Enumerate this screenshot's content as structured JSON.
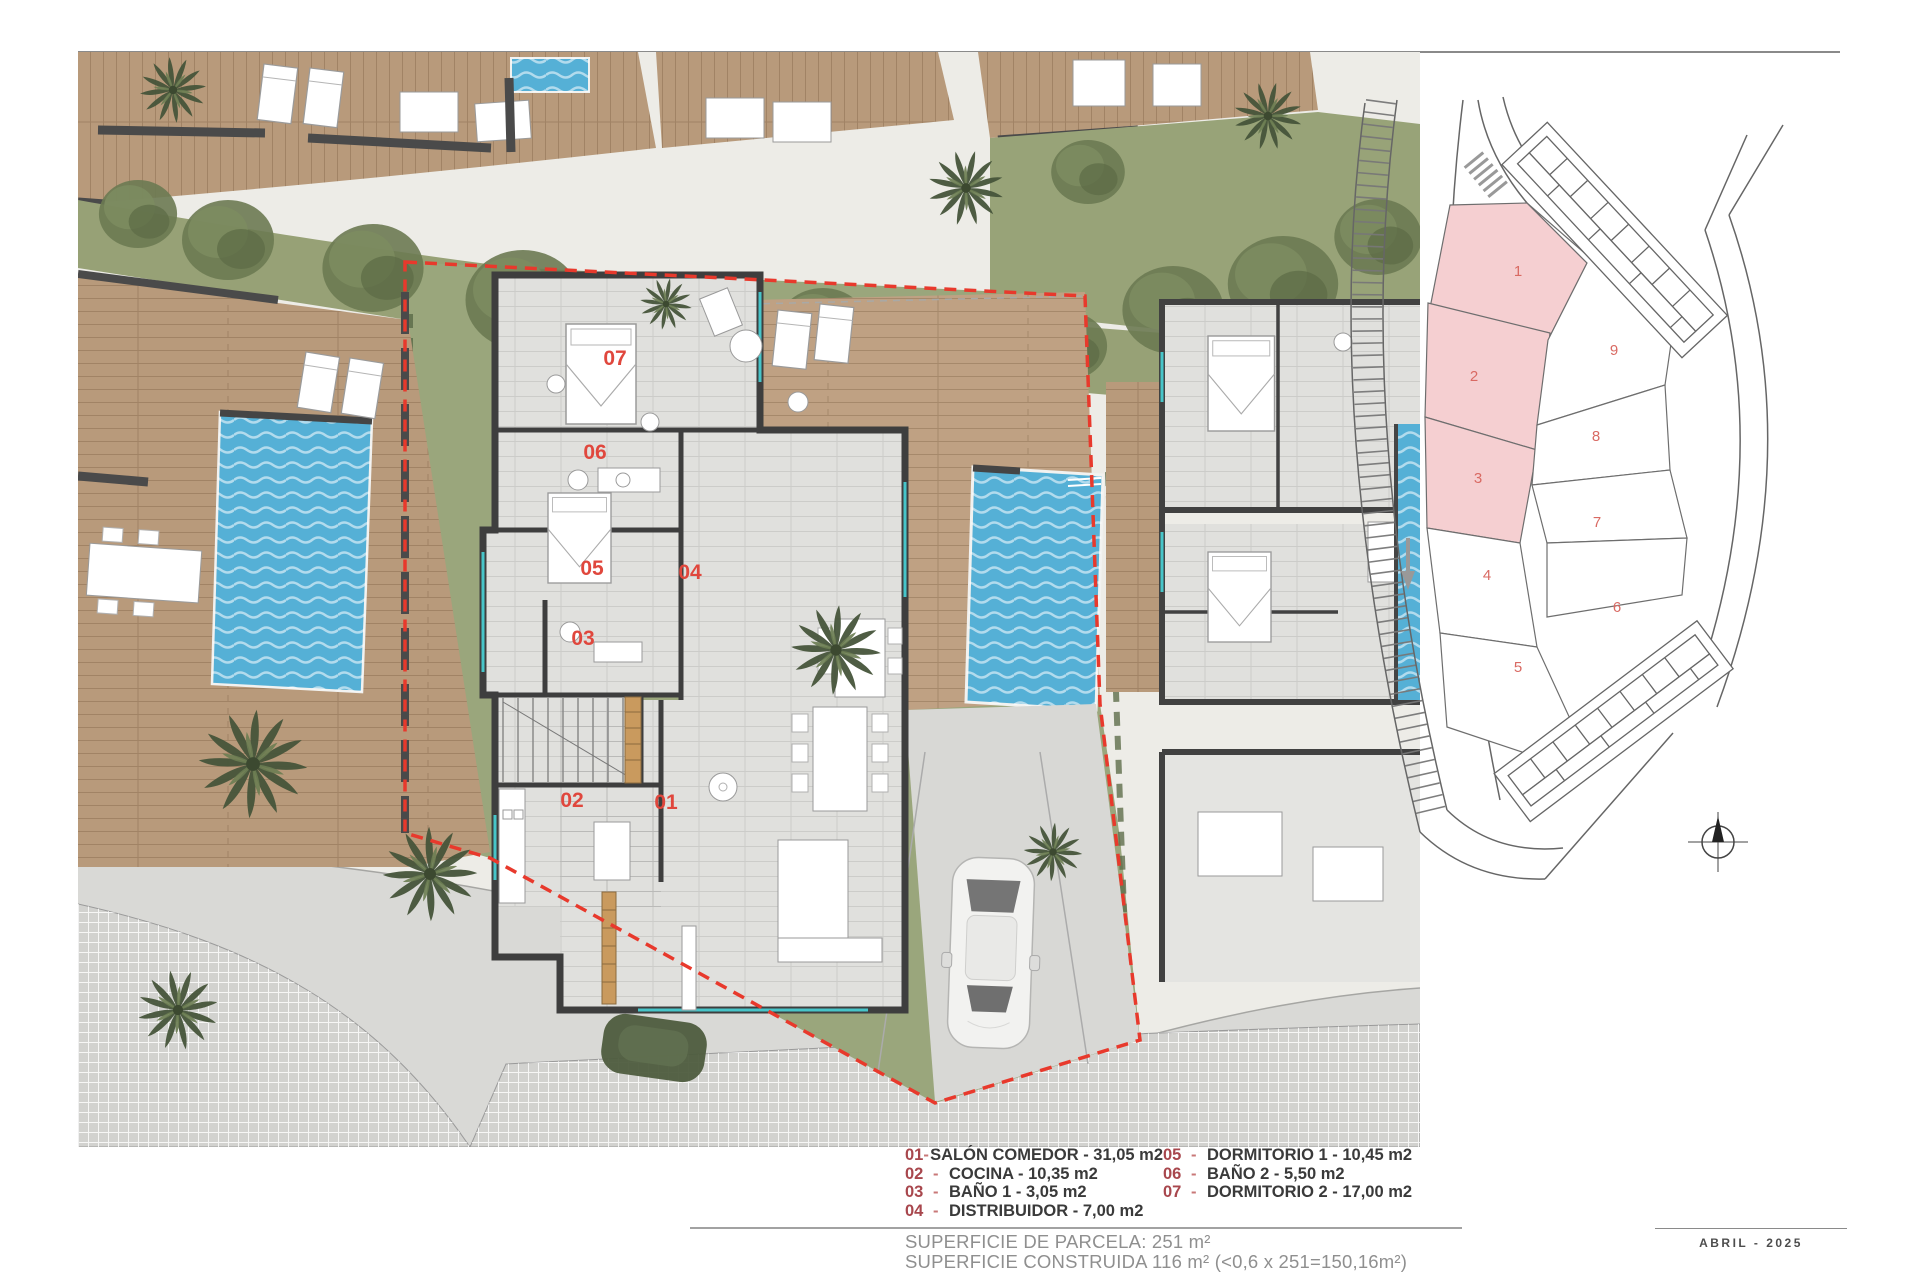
{
  "plan": {
    "room_labels": [
      {
        "num": "07"
      },
      {
        "num": "06"
      },
      {
        "num": "05"
      },
      {
        "num": "04"
      },
      {
        "num": "03"
      },
      {
        "num": "02"
      },
      {
        "num": "01"
      }
    ]
  },
  "site_plan": {
    "plots": [
      {
        "num": "1",
        "highlighted": true
      },
      {
        "num": "2",
        "highlighted": true
      },
      {
        "num": "3",
        "highlighted": true
      },
      {
        "num": "4",
        "highlighted": false
      },
      {
        "num": "5",
        "highlighted": false
      },
      {
        "num": "6",
        "highlighted": false
      },
      {
        "num": "7",
        "highlighted": false
      },
      {
        "num": "8",
        "highlighted": false
      },
      {
        "num": "9",
        "highlighted": false
      }
    ]
  },
  "legend": {
    "separator": "-",
    "items": [
      {
        "num": "01",
        "label": "SALÓN COMEDOR - 31,05 m2"
      },
      {
        "num": "02",
        "label": "COCINA - 10,35 m2"
      },
      {
        "num": "03",
        "label": "BAÑO 1 - 3,05 m2"
      },
      {
        "num": "04",
        "label": "DISTRIBUIDOR - 7,00 m2"
      },
      {
        "num": "05",
        "label": "DORMITORIO 1 - 10,45 m2"
      },
      {
        "num": "06",
        "label": "BAÑO 2 - 5,50 m2"
      },
      {
        "num": "07",
        "label": "DORMITORIO 2 - 17,00 m2"
      }
    ]
  },
  "summary": {
    "parcela": "SUPERFICIE DE PARCELA: 251 m²",
    "construida": "SUPERFICIE CONSTRUIDA 116 m² (<0,6 x 251=150,16m²)"
  },
  "footer": {
    "date": "ABRIL - 2025"
  },
  "colors": {
    "accent_red": "#e0473d",
    "legend_number_red": "#a8474d",
    "plot_pink": "#f5cfd1",
    "plot_number_red": "#d96a63",
    "pool_blue": "#55b0d6",
    "boundary_red": "#e8392c",
    "wood": "#b89a7b",
    "garden_green": "#99a47a"
  }
}
